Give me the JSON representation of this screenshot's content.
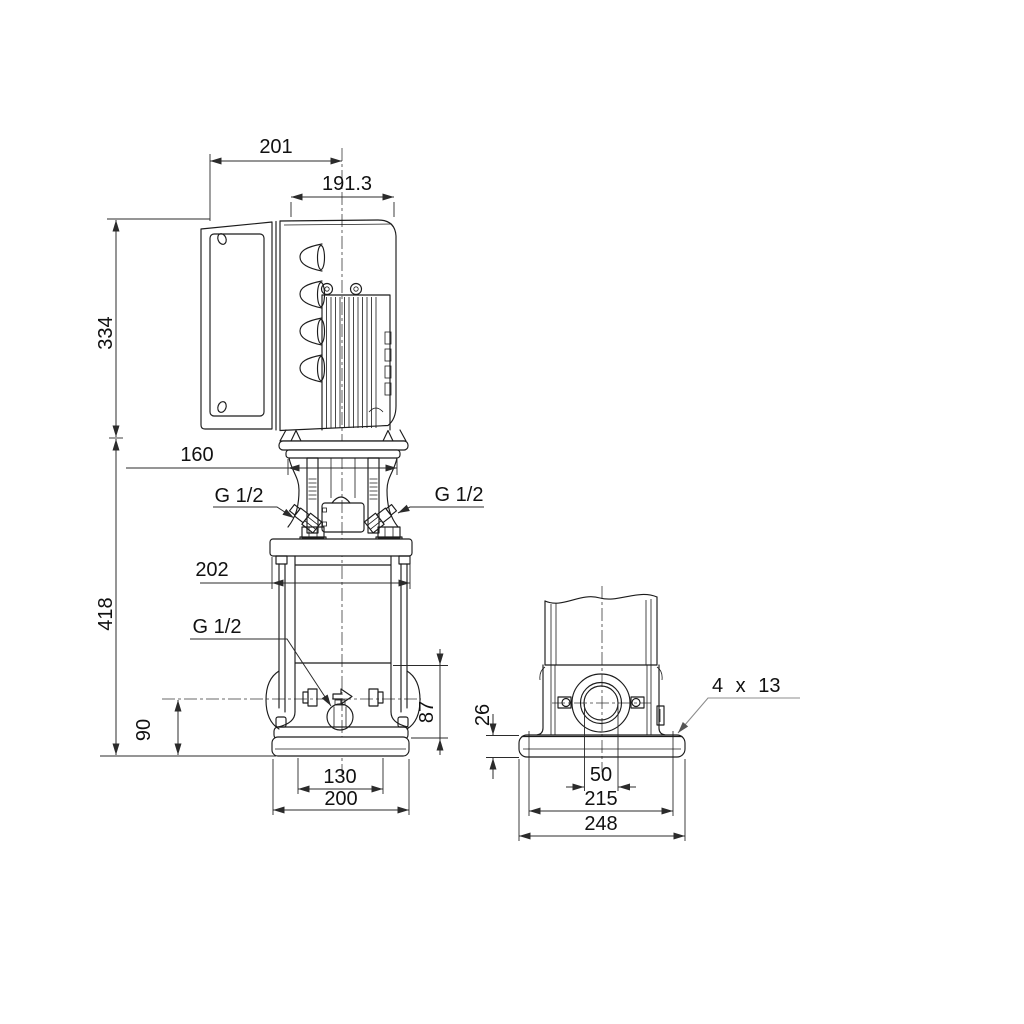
{
  "front_view": {
    "dims": {
      "total_width": "201",
      "motor_width": "191.3",
      "motor_height": "334",
      "flange_width": "160",
      "head_width": "202",
      "pump_height": "418",
      "port_height": "90",
      "base_section_height": "87",
      "foot_inner_width": "130",
      "foot_width": "200"
    },
    "ports": {
      "top_left": "G 1/2",
      "top_right": "G 1/2",
      "drain": "G 1/2"
    }
  },
  "side_view": {
    "dims": {
      "plate_thickness": "26",
      "port_bore": "50",
      "hole_spacing": "215",
      "plate_width": "248"
    },
    "labels": {
      "mounting_holes": "4 x 13"
    }
  },
  "colors": {
    "background": "#ffffff",
    "line": "#1c1c1c",
    "dimension_line": "#2b2b2b",
    "leader_gray": "#8c8c8c"
  }
}
